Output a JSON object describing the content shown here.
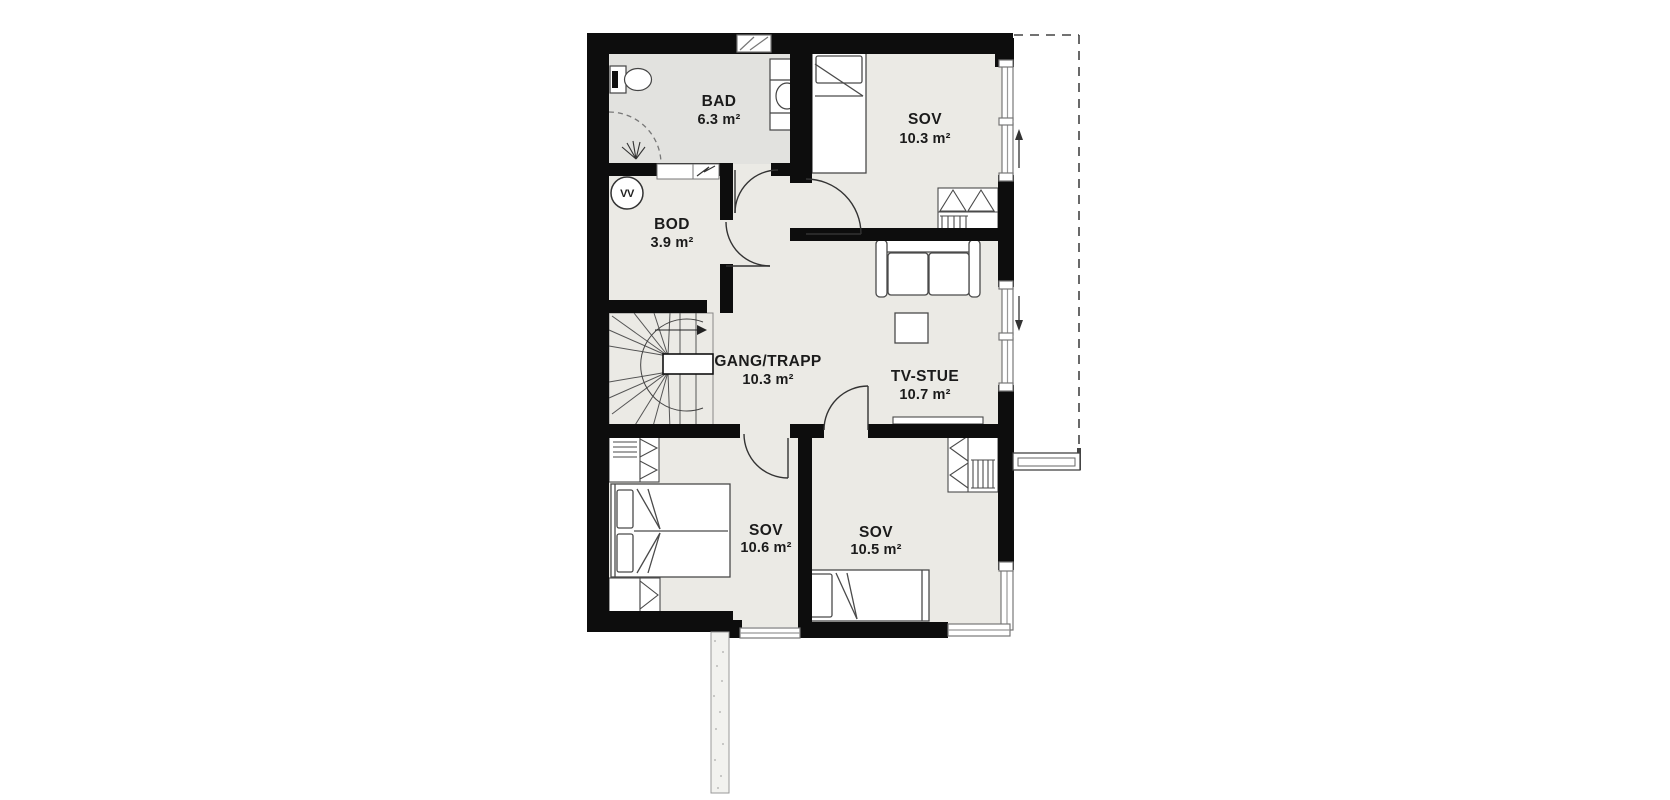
{
  "plan": {
    "colors": {
      "wall": "#0d0d0d",
      "floor": "#ebeae5",
      "bad_floor": "#e2e2df",
      "furniture_stroke": "#4a4a4a",
      "window_stroke": "#777777"
    },
    "rooms": [
      {
        "name": "BAD",
        "area": "6.3 m²"
      },
      {
        "name": "SOV",
        "area": "10.3 m²"
      },
      {
        "name": "BOD",
        "area": "3.9 m²"
      },
      {
        "name": "GANG/TRAPP",
        "area": "10.3 m²"
      },
      {
        "name": "TV-STUE",
        "area": "10.7 m²"
      },
      {
        "name": "SOV",
        "area": "10.6 m²"
      },
      {
        "name": "SOV",
        "area": "10.5 m²"
      }
    ],
    "symbols": {
      "water_heater_label": "VV"
    }
  }
}
